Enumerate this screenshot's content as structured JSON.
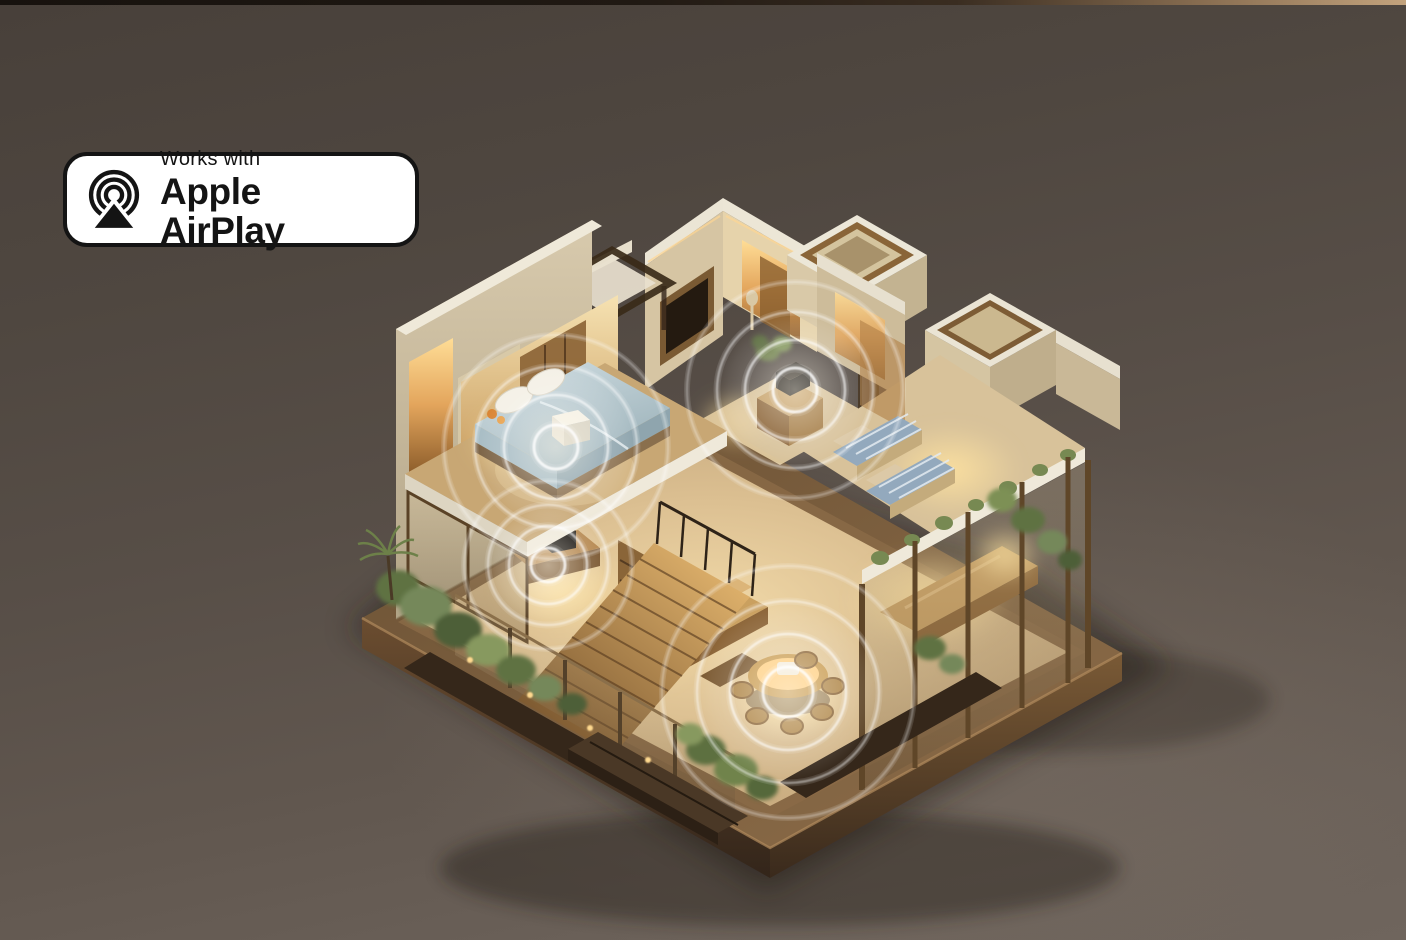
{
  "badge": {
    "line1": "Works with",
    "line2": "Apple AirPlay",
    "background": "#ffffff",
    "border_color": "#141414",
    "text_color": "#141414",
    "icon": "airplay-speaker-icon"
  },
  "scene": {
    "background_top": "#48403a",
    "background_bottom": "#6f655d",
    "wave_color": "#ffffff",
    "wave_ring_fractions": [
      0.2,
      0.46,
      0.72,
      1.0
    ],
    "speaker_zones": [
      {
        "name": "bedroom-speaker-waves",
        "cx": 556,
        "cy": 447,
        "r": 112
      },
      {
        "name": "hallway-speaker-waves",
        "cx": 795,
        "cy": 390,
        "r": 108
      },
      {
        "name": "study-speaker-waves",
        "cx": 548,
        "cy": 565,
        "r": 84
      },
      {
        "name": "dining-speaker-waves",
        "cx": 788,
        "cy": 692,
        "r": 126
      }
    ]
  }
}
